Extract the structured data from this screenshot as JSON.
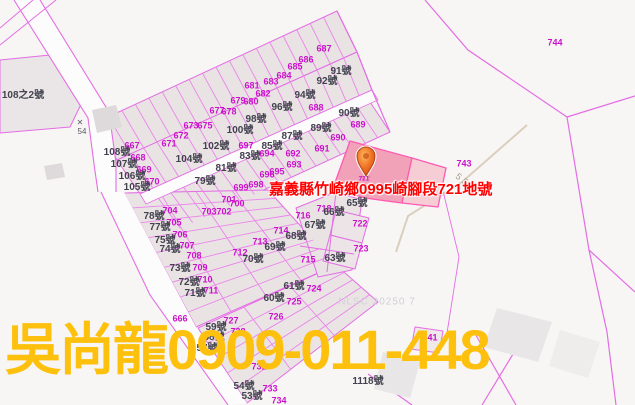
{
  "map": {
    "selected_parcel_label": "嘉義縣竹崎鄉0995崎腳段721地號",
    "contact_watermark": "吳尚龍0909-011-448",
    "source_watermark": "NLSC 20250 7",
    "road_number": "55",
    "benchmark_mark": "✕",
    "benchmark_number": "54",
    "marker_parcel": "721",
    "colors": {
      "parcel_line": "#e36ee3",
      "parcel_number_text": "#cb12cb",
      "address_text": "#42424e",
      "selected_parcel_fill": "#f1a2b8",
      "selected_label_red": "#fe0000",
      "watermark_yellow": "#fdc10d",
      "marker_orange": "#ef7224"
    },
    "parcel_numbers": [
      {
        "t": "667",
        "x": 132,
        "y": 146
      },
      {
        "t": "668",
        "x": 138,
        "y": 158
      },
      {
        "t": "669",
        "x": 144,
        "y": 170
      },
      {
        "t": "670",
        "x": 152,
        "y": 182
      },
      {
        "t": "671",
        "x": 169,
        "y": 144
      },
      {
        "t": "672",
        "x": 181,
        "y": 136
      },
      {
        "t": "673",
        "x": 191,
        "y": 126
      },
      {
        "t": "675",
        "x": 205,
        "y": 126
      },
      {
        "t": "677",
        "x": 217,
        "y": 111
      },
      {
        "t": "678",
        "x": 229,
        "y": 112
      },
      {
        "t": "679",
        "x": 238,
        "y": 101
      },
      {
        "t": "680",
        "x": 251,
        "y": 102
      },
      {
        "t": "681",
        "x": 252,
        "y": 86
      },
      {
        "t": "682",
        "x": 263,
        "y": 94
      },
      {
        "t": "683",
        "x": 271,
        "y": 82
      },
      {
        "t": "684",
        "x": 284,
        "y": 76
      },
      {
        "t": "685",
        "x": 295,
        "y": 67
      },
      {
        "t": "686",
        "x": 306,
        "y": 60
      },
      {
        "t": "687",
        "x": 324,
        "y": 49
      },
      {
        "t": "688",
        "x": 316,
        "y": 108
      },
      {
        "t": "689",
        "x": 358,
        "y": 125
      },
      {
        "t": "690",
        "x": 338,
        "y": 138
      },
      {
        "t": "691",
        "x": 322,
        "y": 149
      },
      {
        "t": "692",
        "x": 293,
        "y": 154
      },
      {
        "t": "693",
        "x": 294,
        "y": 165
      },
      {
        "t": "694",
        "x": 267,
        "y": 154
      },
      {
        "t": "695",
        "x": 277,
        "y": 172
      },
      {
        "t": "696",
        "x": 267,
        "y": 175
      },
      {
        "t": "697",
        "x": 246,
        "y": 146
      },
      {
        "t": "698",
        "x": 256,
        "y": 185
      },
      {
        "t": "699",
        "x": 241,
        "y": 188
      },
      {
        "t": "700",
        "x": 237,
        "y": 204
      },
      {
        "t": "701",
        "x": 229,
        "y": 200
      },
      {
        "t": "702",
        "x": 224,
        "y": 212
      },
      {
        "t": "703",
        "x": 209,
        "y": 212
      },
      {
        "t": "704",
        "x": 170,
        "y": 211
      },
      {
        "t": "705",
        "x": 174,
        "y": 223
      },
      {
        "t": "706",
        "x": 180,
        "y": 235
      },
      {
        "t": "707",
        "x": 187,
        "y": 246
      },
      {
        "t": "708",
        "x": 194,
        "y": 256
      },
      {
        "t": "709",
        "x": 200,
        "y": 268
      },
      {
        "t": "710",
        "x": 205,
        "y": 280
      },
      {
        "t": "711",
        "x": 211,
        "y": 291
      },
      {
        "t": "712",
        "x": 240,
        "y": 253
      },
      {
        "t": "713",
        "x": 260,
        "y": 242
      },
      {
        "t": "714",
        "x": 281,
        "y": 231
      },
      {
        "t": "715",
        "x": 308,
        "y": 260
      },
      {
        "t": "716",
        "x": 303,
        "y": 216
      },
      {
        "t": "718",
        "x": 324,
        "y": 209
      },
      {
        "t": "722",
        "x": 360,
        "y": 224
      },
      {
        "t": "723",
        "x": 361,
        "y": 249
      },
      {
        "t": "724",
        "x": 314,
        "y": 289
      },
      {
        "t": "725",
        "x": 294,
        "y": 302
      },
      {
        "t": "726",
        "x": 276,
        "y": 317
      },
      {
        "t": "727",
        "x": 231,
        "y": 321
      },
      {
        "t": "728",
        "x": 238,
        "y": 332
      },
      {
        "t": "731",
        "x": 259,
        "y": 367
      },
      {
        "t": "733",
        "x": 270,
        "y": 389
      },
      {
        "t": "734",
        "x": 279,
        "y": 401
      },
      {
        "t": "666",
        "x": 180,
        "y": 319
      },
      {
        "t": "741",
        "x": 430,
        "y": 338
      },
      {
        "t": "743",
        "x": 464,
        "y": 164
      },
      {
        "t": "744",
        "x": 555,
        "y": 43
      }
    ],
    "house_numbers": [
      {
        "t": "91號",
        "x": 341,
        "y": 72
      },
      {
        "t": "92號",
        "x": 327,
        "y": 82
      },
      {
        "t": "94號",
        "x": 305,
        "y": 96
      },
      {
        "t": "96號",
        "x": 282,
        "y": 108
      },
      {
        "t": "98號",
        "x": 256,
        "y": 120
      },
      {
        "t": "100號",
        "x": 240,
        "y": 131
      },
      {
        "t": "102號",
        "x": 216,
        "y": 147
      },
      {
        "t": "104號",
        "x": 189,
        "y": 160
      },
      {
        "t": "108號",
        "x": 117,
        "y": 153
      },
      {
        "t": "107號",
        "x": 124,
        "y": 165
      },
      {
        "t": "106號",
        "x": 132,
        "y": 177
      },
      {
        "t": "105號",
        "x": 137,
        "y": 188
      },
      {
        "t": "90號",
        "x": 349,
        "y": 114
      },
      {
        "t": "89號",
        "x": 321,
        "y": 129
      },
      {
        "t": "87號",
        "x": 292,
        "y": 137
      },
      {
        "t": "85號",
        "x": 272,
        "y": 147
      },
      {
        "t": "83號",
        "x": 250,
        "y": 157
      },
      {
        "t": "81號",
        "x": 226,
        "y": 169
      },
      {
        "t": "79號",
        "x": 205,
        "y": 182
      },
      {
        "t": "78號",
        "x": 154,
        "y": 217
      },
      {
        "t": "77號",
        "x": 160,
        "y": 228
      },
      {
        "t": "75號",
        "x": 165,
        "y": 241
      },
      {
        "t": "74號",
        "x": 170,
        "y": 250
      },
      {
        "t": "73號",
        "x": 180,
        "y": 269
      },
      {
        "t": "72號",
        "x": 189,
        "y": 283
      },
      {
        "t": "71號",
        "x": 195,
        "y": 294
      },
      {
        "t": "70號",
        "x": 253,
        "y": 260
      },
      {
        "t": "69號",
        "x": 275,
        "y": 248
      },
      {
        "t": "68號",
        "x": 296,
        "y": 237
      },
      {
        "t": "67號",
        "x": 315,
        "y": 226
      },
      {
        "t": "66號",
        "x": 334,
        "y": 213
      },
      {
        "t": "65號",
        "x": 357,
        "y": 204
      },
      {
        "t": "63號",
        "x": 335,
        "y": 259
      },
      {
        "t": "61號",
        "x": 294,
        "y": 287
      },
      {
        "t": "60號",
        "x": 274,
        "y": 299
      },
      {
        "t": "59號",
        "x": 216,
        "y": 328
      },
      {
        "t": "58號",
        "x": 214,
        "y": 338
      },
      {
        "t": "57號",
        "x": 207,
        "y": 349
      },
      {
        "t": "54號",
        "x": 244,
        "y": 387
      },
      {
        "t": "53號",
        "x": 252,
        "y": 397
      },
      {
        "t": "1118號",
        "x": 368,
        "y": 382
      },
      {
        "t": "108之2號",
        "x": 23,
        "y": 96
      }
    ]
  }
}
